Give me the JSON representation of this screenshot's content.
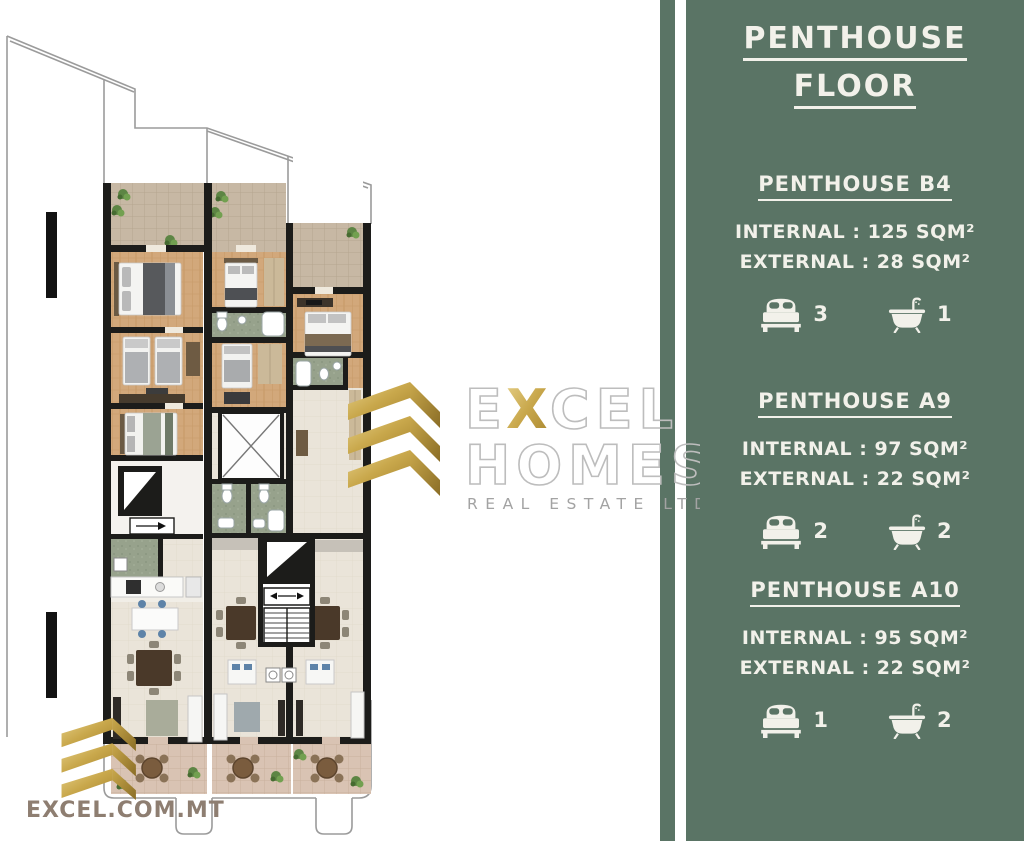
{
  "panel": {
    "title": {
      "line1": "PENTHOUSE",
      "line2": "FLOOR"
    },
    "units": [
      {
        "name": "PENTHOUSE B4",
        "internal": "INTERNAL : 125 SQM²",
        "external": "EXTERNAL : 28 SQM²",
        "bedrooms": "3",
        "bathrooms": "1"
      },
      {
        "name": "PENTHOUSE A9",
        "internal": "INTERNAL : 97 SQM²",
        "external": "EXTERNAL : 22 SQM²",
        "bedrooms": "2",
        "bathrooms": "2"
      },
      {
        "name": "PENTHOUSE A10",
        "internal": "INTERNAL : 95 SQM²",
        "external": "EXTERNAL : 22 SQM²",
        "bedrooms": "1",
        "bathrooms": "2"
      }
    ]
  },
  "watermark": {
    "brand_parts": [
      "E",
      "X",
      "CEL"
    ],
    "brand_line2": "HOMES",
    "tagline": "REAL ESTATE LTD"
  },
  "footer": {
    "website": "EXCEL.COM.MT"
  },
  "icons": {
    "bedrooms": "bed-icon",
    "bathrooms": "bath-icon",
    "logo": "gold-chevrons-icon"
  },
  "colors": {
    "panel_green": "#5a7465",
    "panel_text": "#f2f1ea",
    "accent_gold": "#c9a84c",
    "website_text": "#8e7e71",
    "terrace_tile": "#c7b8a4",
    "wood_floor": "#d2a87b",
    "bathroom_floor": "#97a28c",
    "living_floor": "#eae4d9",
    "balcony_tile": "#d9c3b3"
  }
}
